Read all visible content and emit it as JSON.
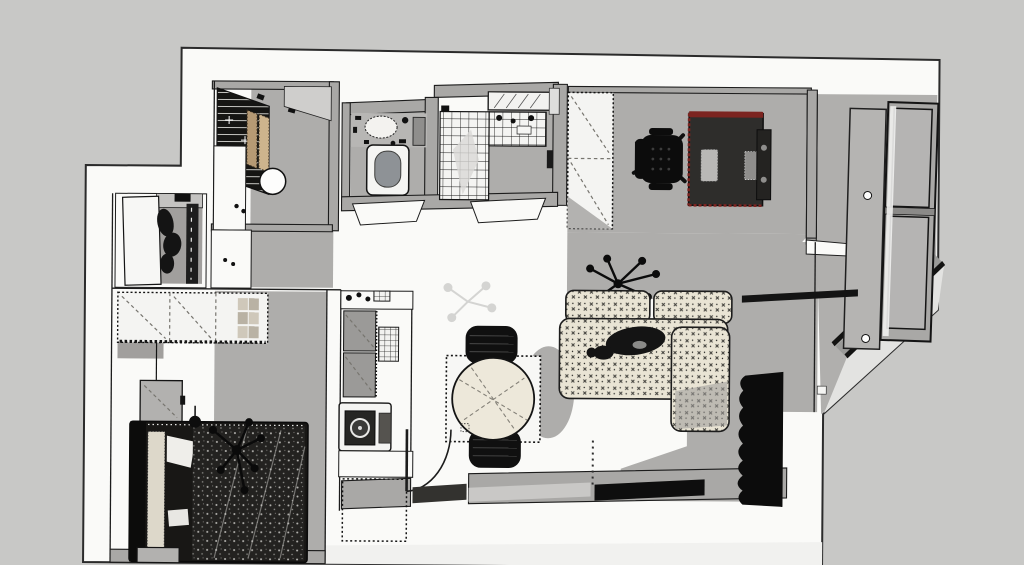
{
  "meta": {
    "type": "3d-floor-plan-top-view",
    "style": "sketchup-monochrome",
    "visible_text": "none"
  },
  "palette": {
    "background": "#c8c8c6",
    "plate": "#fafaf8",
    "wall": "#a9a8a6",
    "wallDark": "#9e9d9b",
    "shadow": "#aeadab",
    "shadow2": "#a19f9d",
    "line": "#1c1c1c",
    "dark": "#131312",
    "cream": "#e9e4d4",
    "tableCream": "#ede8da",
    "wood": "#b69a74",
    "woodLight": "#cdb48d",
    "accentRed": "#7c2420",
    "glass": "#b5b4b3",
    "sill": "#e3e3e1",
    "doorGray": "#b5b4b2",
    "mat": "#c9c8c6"
  },
  "scene": {
    "rooms": [
      {
        "name": "kitchen",
        "items": [
          "slat-rack",
          "cutting-boards",
          "round-basin",
          "counter"
        ]
      },
      {
        "name": "toilet-room",
        "items": [
          "vanity",
          "toilet"
        ]
      },
      {
        "name": "shower-room",
        "items": [
          "tiled-shower-floor",
          "tiled-vanity",
          "tray"
        ]
      },
      {
        "name": "study",
        "items": [
          "wardrobe",
          "office-chair",
          "desk"
        ]
      },
      {
        "name": "living-room",
        "items": [
          "l-sofa",
          "pendant-lamp",
          "tv-unit",
          "doormats"
        ]
      },
      {
        "name": "dining",
        "items": [
          "round-table",
          "two-chairs",
          "rug"
        ]
      },
      {
        "name": "utility-column",
        "items": [
          "cabinets",
          "washing-machine",
          "counter",
          "footprint"
        ]
      },
      {
        "name": "entry",
        "items": [
          "door-swing-arc",
          "threshold"
        ]
      },
      {
        "name": "entry-closet",
        "items": [
          "open-door",
          "hanging-clothes"
        ]
      },
      {
        "name": "bedroom",
        "items": [
          "wardrobe",
          "nightstand",
          "double-bed",
          "plant",
          "pendant"
        ]
      },
      {
        "name": "balcony",
        "items": [
          "glazed-door",
          "window-stack",
          "diagonal-window-band",
          "sill"
        ]
      }
    ]
  }
}
